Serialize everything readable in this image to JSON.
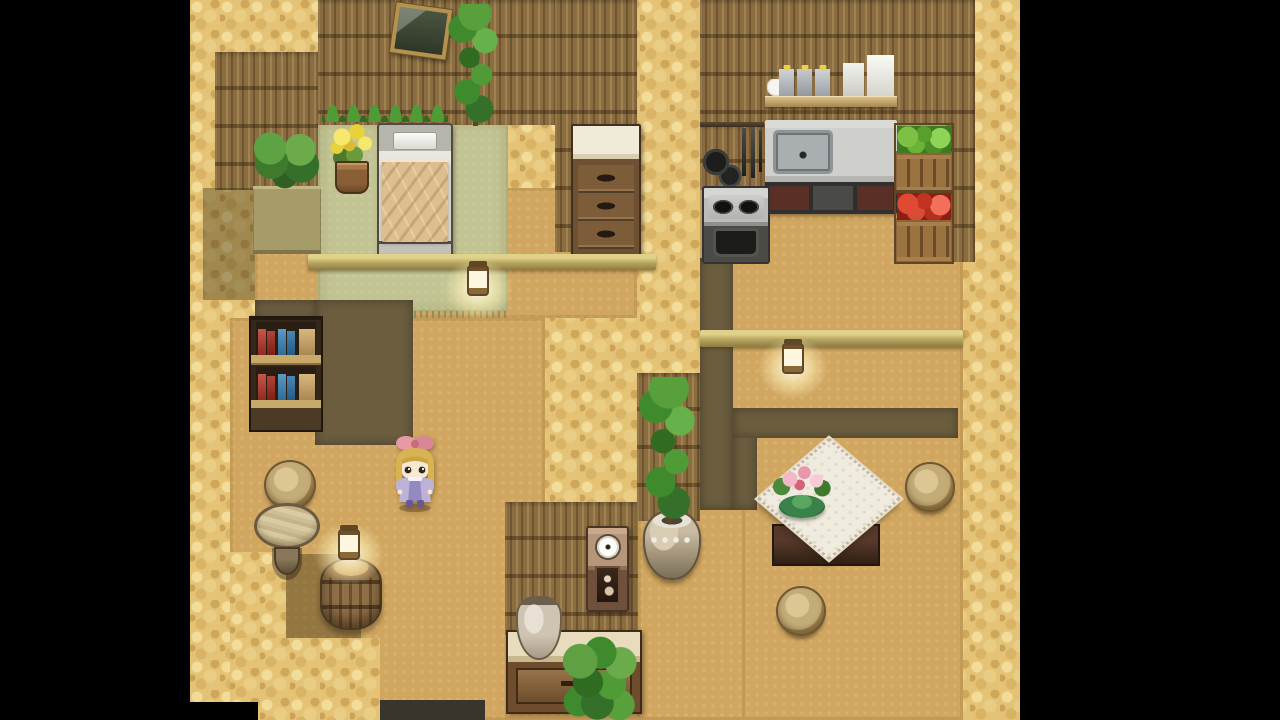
{
  "meta": {
    "app_type": "2d-rpg-game",
    "scene": "house-interior",
    "visible_text": [],
    "description": "Top-down RPG Maker style house interior with letterboxed black side bars: bedroom with bed, picture frame and dresser; kitchen with wall shelf of jars, hanging pans, sink counter, stove and vegetable crates; hallway with potion shelf, stools, round table and a lantern on a barrel; dining room with lace-cloth table, flower centerpiece and stools; a blonde child character in a lavender dress with a pink bow stands in the hallway."
  },
  "palette": {
    "letterbox": "#000000",
    "sand_wall_top": "#e4c377",
    "floor_tan": "#d0a660",
    "wall_face_thatch": "#8a6d41",
    "partition_olive": "#6b5d3e",
    "mat_green": "#c3c493",
    "beam_gold": "#b7a65f",
    "lantern_glow": "#fff3cf",
    "bed_blanket": "#dcbd8d",
    "tablecloth": "#f0ebdf",
    "dress_lavender": "#bcb2d8",
    "hair_blonde": "#d9b351",
    "bow_pink": "#e59aa6"
  },
  "scene": {
    "width": 1280,
    "height": 720,
    "game_area": {
      "x": 190,
      "w": 830
    },
    "entities": [
      {
        "n": "wall-top-base",
        "t": "cobble",
        "x": 190,
        "y": 0,
        "w": 830,
        "h": 720
      },
      {
        "n": "bedroom-floor",
        "t": "floor",
        "x": 255,
        "y": 188,
        "w": 382,
        "h": 130
      },
      {
        "n": "hallway-floor",
        "t": "floor",
        "x": 230,
        "y": 318,
        "w": 315,
        "h": 402
      },
      {
        "n": "kitchen-dining-floor",
        "t": "floor",
        "x": 700,
        "y": 125,
        "w": 263,
        "h": 595
      },
      {
        "n": "bottom-center-floor",
        "t": "floor",
        "x": 505,
        "y": 630,
        "w": 240,
        "h": 90
      },
      {
        "n": "center-east-floor",
        "t": "floor",
        "x": 638,
        "y": 505,
        "w": 107,
        "h": 215
      },
      {
        "n": "bedroom-mat",
        "t": "mat",
        "x": 318,
        "y": 120,
        "w": 190,
        "h": 192
      },
      {
        "n": "bedroom-left-wall",
        "t": "thatch",
        "x": 215,
        "y": 52,
        "w": 103,
        "h": 138
      },
      {
        "n": "bedroom-back-wall",
        "t": "thatch",
        "x": 318,
        "y": 0,
        "w": 250,
        "h": 125
      },
      {
        "n": "dresser-nook-wall",
        "t": "thatch",
        "x": 555,
        "y": 0,
        "w": 82,
        "h": 252
      },
      {
        "n": "kitchen-back-wall",
        "t": "thatch",
        "x": 700,
        "y": 0,
        "w": 248,
        "h": 125
      },
      {
        "n": "kitchen-west-wall",
        "t": "thatch",
        "x": 700,
        "y": 125,
        "w": 66,
        "h": 65
      },
      {
        "n": "kitchen-east-wall",
        "t": "thatch",
        "x": 946,
        "y": 0,
        "w": 29,
        "h": 262
      },
      {
        "n": "center-wall-face",
        "t": "thatch",
        "x": 505,
        "y": 502,
        "w": 133,
        "h": 133
      },
      {
        "n": "vine-wall-face",
        "t": "thatch",
        "x": 637,
        "y": 373,
        "w": 63,
        "h": 148
      },
      {
        "n": "west-wall-shadow",
        "t": "shadow",
        "x": 203,
        "y": 188,
        "w": 52,
        "h": 112
      },
      {
        "n": "bookshelf-wall-lip",
        "t": "olive",
        "x": 255,
        "y": 300,
        "w": 62,
        "h": 20
      },
      {
        "n": "bedroom-south-wall",
        "t": "olive",
        "x": 315,
        "y": 300,
        "w": 98,
        "h": 145
      },
      {
        "n": "dining-west-wall",
        "t": "olive",
        "x": 700,
        "y": 258,
        "w": 33,
        "h": 252
      },
      {
        "n": "dining-inner-wall-post",
        "t": "olive",
        "x": 733,
        "y": 408,
        "w": 24,
        "h": 102
      },
      {
        "n": "dining-inner-wall",
        "t": "olive",
        "x": 733,
        "y": 408,
        "w": 225,
        "h": 30
      },
      {
        "n": "barrel-corner-shadow",
        "t": "shadow",
        "x": 283,
        "y": 554,
        "w": 78,
        "h": 88
      },
      {
        "n": "southwest-wall-top",
        "t": "cobble",
        "x": 230,
        "y": 552,
        "w": 56,
        "h": 168
      },
      {
        "n": "south-wall-top",
        "t": "cobble",
        "x": 230,
        "y": 638,
        "w": 150,
        "h": 82
      },
      {
        "n": "south-floor-shadow",
        "t": "shadow-dark",
        "x": 380,
        "y": 700,
        "w": 105,
        "h": 20
      },
      {
        "n": "doorway-gap",
        "t": "black",
        "x": 190,
        "y": 702,
        "w": 68,
        "h": 18
      },
      {
        "n": "planter-ledge",
        "t": "ledge",
        "x": 253,
        "y": 186,
        "w": 68,
        "h": 68
      },
      {
        "n": "potted-plants",
        "t": "plantpair",
        "x": 251,
        "y": 124,
        "w": 68,
        "h": 68
      },
      {
        "n": "wall-grass",
        "t": "grass",
        "x": 322,
        "y": 84,
        "w": 126,
        "h": 38
      },
      {
        "n": "picture-frame",
        "t": "frame",
        "x": 393,
        "y": 6,
        "w": 48,
        "h": 42,
        "r": 8
      },
      {
        "n": "wall-vine",
        "t": "vine",
        "x": 447,
        "y": 4,
        "w": 56,
        "h": 122
      },
      {
        "n": "yellow-flower-pot",
        "t": "flowerpot",
        "x": 327,
        "y": 124,
        "w": 50,
        "h": 70
      },
      {
        "n": "bed",
        "t": "bed",
        "x": 377,
        "y": 123,
        "w": 72,
        "h": 132
      },
      {
        "n": "dresser",
        "t": "dresser",
        "x": 571,
        "y": 124,
        "w": 66,
        "h": 128
      },
      {
        "n": "kitchen-shelf",
        "t": "shelf",
        "x": 765,
        "y": 53,
        "w": 132,
        "h": 54
      },
      {
        "n": "utensil-rack",
        "t": "rack",
        "x": 700,
        "y": 120,
        "w": 64,
        "h": 70
      },
      {
        "n": "sink-counter",
        "t": "sink",
        "x": 765,
        "y": 120,
        "w": 132,
        "h": 94
      },
      {
        "n": "stove",
        "t": "stove",
        "x": 702,
        "y": 186,
        "w": 64,
        "h": 74
      },
      {
        "n": "vegetable-crate-green",
        "t": "crate-green",
        "x": 894,
        "y": 123,
        "w": 56,
        "h": 67
      },
      {
        "n": "vegetable-crate-red",
        "t": "crate-red",
        "x": 894,
        "y": 190,
        "w": 56,
        "h": 70
      },
      {
        "n": "bedroom-beam",
        "t": "beam",
        "x": 308,
        "y": 254,
        "w": 348,
        "h": 16
      },
      {
        "n": "bedroom-lantern",
        "t": "lantern",
        "x": 458,
        "y": 256,
        "w": 40,
        "h": 58
      },
      {
        "n": "dining-beam",
        "t": "beam",
        "x": 700,
        "y": 330,
        "w": 263,
        "h": 17
      },
      {
        "n": "dining-lantern",
        "t": "lantern",
        "x": 772,
        "y": 334,
        "w": 42,
        "h": 60
      },
      {
        "n": "potion-shelf",
        "t": "bookshelf",
        "x": 249,
        "y": 316,
        "w": 70,
        "h": 112
      },
      {
        "n": "stool-west",
        "t": "stool",
        "x": 264,
        "y": 460,
        "w": 48,
        "h": 46
      },
      {
        "n": "round-table",
        "t": "rtable",
        "x": 254,
        "y": 503,
        "w": 66,
        "h": 72
      },
      {
        "n": "barrel",
        "t": "barrel",
        "x": 320,
        "y": 558,
        "w": 58,
        "h": 68
      },
      {
        "n": "barrel-lantern",
        "t": "lantern",
        "x": 328,
        "y": 520,
        "w": 42,
        "h": 60
      },
      {
        "n": "wall-clock",
        "t": "clock",
        "x": 586,
        "y": 526,
        "w": 39,
        "h": 82
      },
      {
        "n": "ceramic-pot",
        "t": "bigpot",
        "x": 643,
        "y": 510,
        "w": 54,
        "h": 66
      },
      {
        "n": "climbing-vine",
        "t": "vine",
        "x": 639,
        "y": 377,
        "w": 60,
        "h": 146
      },
      {
        "n": "sideboard",
        "t": "sideboard",
        "x": 506,
        "y": 630,
        "w": 132,
        "h": 80
      },
      {
        "n": "vase",
        "t": "vase",
        "x": 516,
        "y": 596,
        "w": 42,
        "h": 60
      },
      {
        "n": "sideboard-plant",
        "t": "bush",
        "x": 563,
        "y": 636,
        "w": 78,
        "h": 84
      },
      {
        "n": "dining-table",
        "t": "dtable",
        "x": 758,
        "y": 436,
        "w": 136,
        "h": 152
      },
      {
        "n": "flower-centerpiece",
        "t": "flowers",
        "x": 772,
        "y": 462,
        "w": 60,
        "h": 58
      },
      {
        "n": "stool-east",
        "t": "stool",
        "x": 905,
        "y": 462,
        "w": 46,
        "h": 46
      },
      {
        "n": "stool-south",
        "t": "stool",
        "x": 776,
        "y": 586,
        "w": 46,
        "h": 46
      },
      {
        "n": "player-character",
        "t": "character",
        "x": 388,
        "y": 434,
        "w": 54,
        "h": 78,
        "i": "true"
      },
      {
        "n": "letterbox-left",
        "t": "black",
        "x": 0,
        "y": 0,
        "w": 190,
        "h": 720
      },
      {
        "n": "letterbox-right",
        "t": "black",
        "x": 1020,
        "y": 0,
        "w": 260,
        "h": 720
      }
    ]
  }
}
